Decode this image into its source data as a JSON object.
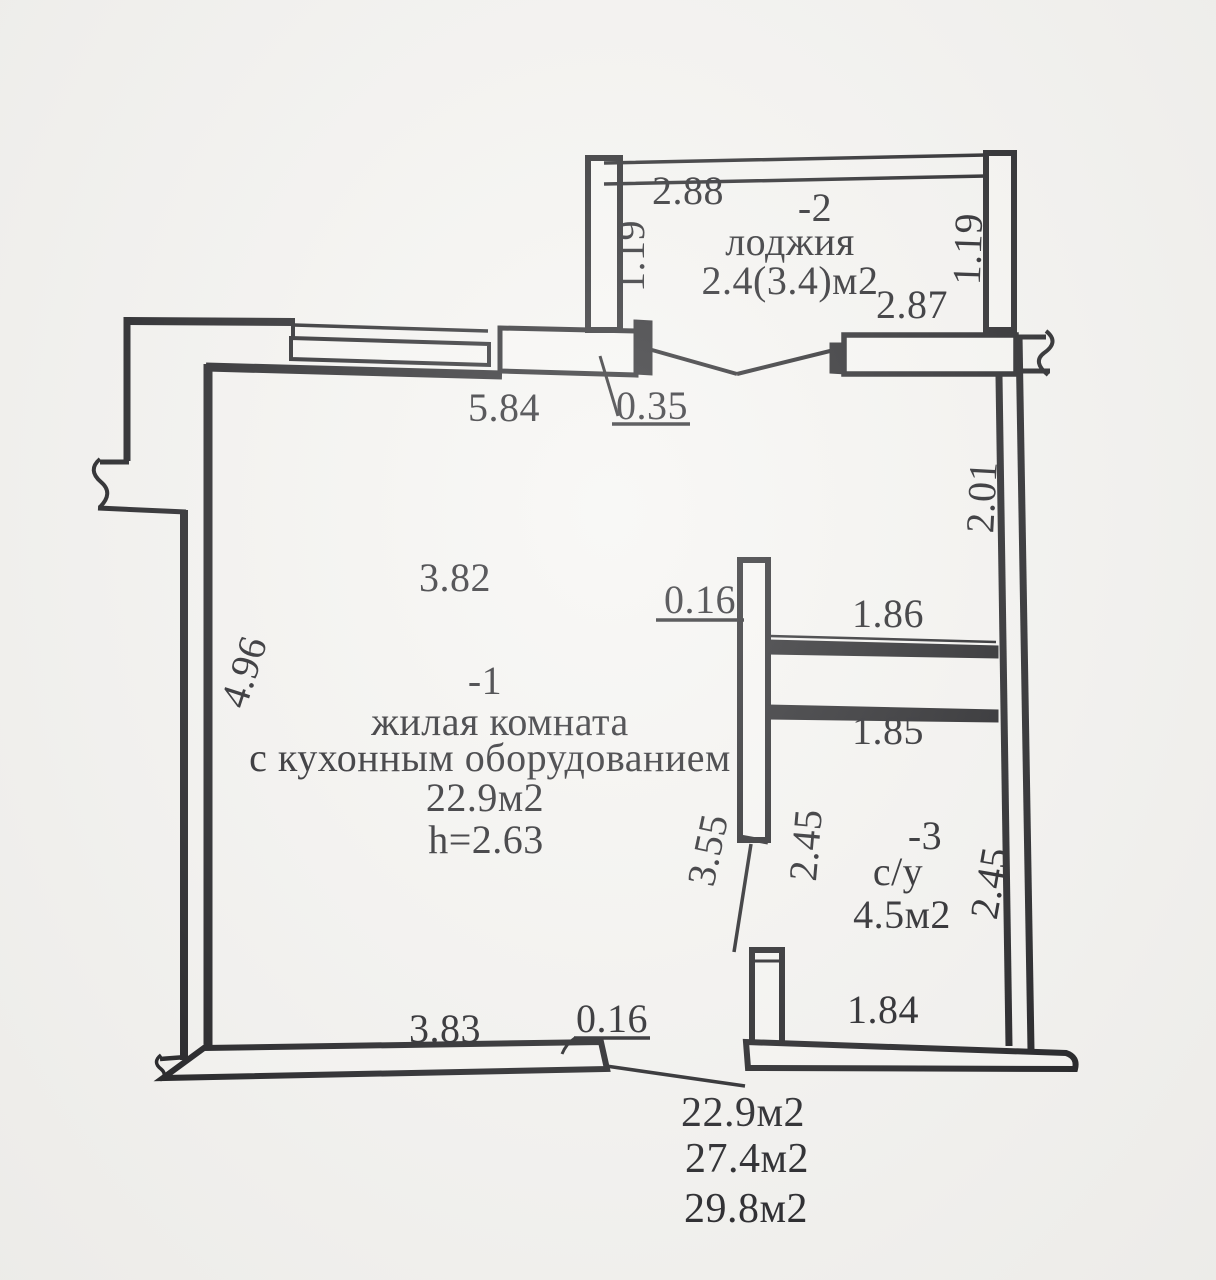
{
  "palette": {
    "ink": "#1b1b20",
    "paper": "#f5f4f1"
  },
  "loggia": {
    "id": "-2",
    "name": "лоджия",
    "area": "2.4(3.4)м2",
    "dim_top": "2.88",
    "dim_bottom": "2.87",
    "dim_left": "1.19",
    "dim_right": "1.19"
  },
  "room": {
    "id": "-1",
    "name_line1": "жилая комната",
    "name_line2": "с кухонным оборудованием",
    "area": "22.9м2",
    "ceiling_height": "h=2.63",
    "dim_top": "3.82",
    "dim_left": "4.96",
    "dim_bottom": "3.83"
  },
  "bathroom": {
    "id": "-3",
    "name": "с/у",
    "area": "4.5м2",
    "dim_top": "1.86",
    "dim_mid": "1.85",
    "dim_left": "2.45",
    "dim_right": "2.45",
    "dim_bottom": "1.84"
  },
  "dims": {
    "window_wall": "5.84",
    "balcony_door": "0.35",
    "right_wall_upper": "2.01",
    "partition_thickness": "0.16",
    "partition_length": "3.55",
    "bottom_wall_thickness": "0.16"
  },
  "totals": {
    "living_area": "22.9м2",
    "apartment_area": "27.4м2",
    "total_area": "29.8м2"
  }
}
